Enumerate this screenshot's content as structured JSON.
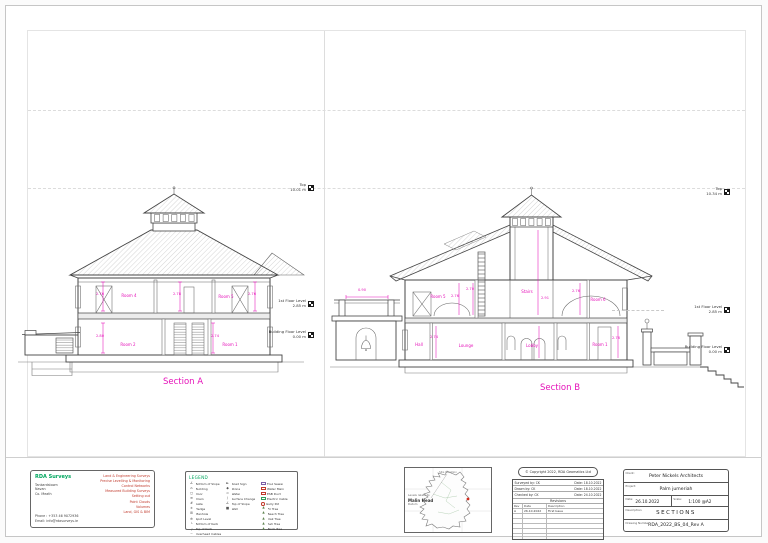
{
  "sectionA": {
    "title": "Section A",
    "levels": [
      {
        "label": "Top",
        "value": "10.01 m"
      },
      {
        "label": "1st Floor Level",
        "value": "2.85 m"
      },
      {
        "label": "Building Floor Level",
        "value": "0.00 m"
      }
    ],
    "labels": [
      {
        "text": "2.76"
      },
      {
        "text": "2.78"
      },
      {
        "text": "2.76"
      },
      {
        "text": "Room 4"
      },
      {
        "text": "Room 5"
      },
      {
        "text": "2.80"
      },
      {
        "text": "2.74"
      },
      {
        "text": "Room 2"
      },
      {
        "text": "Room 1"
      }
    ]
  },
  "sectionB": {
    "title": "Section B",
    "levels": [
      {
        "label": "Top",
        "value": "10.34 m"
      },
      {
        "label": "1st Floor Level",
        "value": "2.85 m"
      },
      {
        "label": "Building Floor Level",
        "value": "0.00 m"
      }
    ],
    "labels": [
      {
        "text": "Room 5"
      },
      {
        "text": "2.76"
      },
      {
        "text": "2.70"
      },
      {
        "text": "Stairs"
      },
      {
        "text": "2.91"
      },
      {
        "text": "2.76"
      },
      {
        "text": "Room 6"
      },
      {
        "text": "0.90"
      },
      {
        "text": "Hall"
      },
      {
        "text": "2.74"
      },
      {
        "text": "Lounge"
      },
      {
        "text": "Lobby"
      },
      {
        "text": "Room 1"
      },
      {
        "text": "2.76"
      }
    ]
  },
  "surveyor": {
    "name": "RDA Surveys",
    "address": [
      "Tankardstown",
      "Navan",
      "Co. Meath"
    ],
    "phone": "Phone : +353 46 9072936",
    "email": "Email: info@rdasurveys.ie",
    "services": [
      "Land & Engineering Surveys",
      "Precise Levelling & Monitoring",
      "Control Networks",
      "Measured Building Surveys",
      "Setting out",
      "Point Clouds",
      "Volumes",
      "Land, GIS & BIM"
    ]
  },
  "legend": {
    "title": "LEGEND",
    "col1": [
      {
        "icon": "slope",
        "label": "Bottom of Slope"
      },
      {
        "icon": "building",
        "label": "Building"
      },
      {
        "icon": "door",
        "label": "Door"
      },
      {
        "icon": "drain",
        "label": "Drain"
      },
      {
        "icon": "gate",
        "label": "Gate"
      },
      {
        "icon": "hedge",
        "label": "Hedge"
      },
      {
        "icon": "manhole",
        "label": "Manhole"
      },
      {
        "icon": "spot-level",
        "label": "Spot Level"
      },
      {
        "icon": "kerb-bottom",
        "label": "Bottom of Kerb"
      },
      {
        "icon": "kerb-top",
        "label": "Top of Kerb"
      },
      {
        "icon": "cables",
        "label": "Overhead Cables"
      }
    ],
    "col2": [
      {
        "icon": "sign",
        "label": "Road Sign"
      },
      {
        "icon": "stone",
        "label": "Stone"
      },
      {
        "icon": "water",
        "label": "Water"
      },
      {
        "icon": "surface",
        "label": "Surface Change"
      },
      {
        "icon": "slope",
        "label": "Top of Slope"
      },
      {
        "icon": "wall",
        "label": "Wall"
      }
    ],
    "col3": [
      {
        "icon": "box-purple",
        "label": "Foul Sewer"
      },
      {
        "icon": "box-red",
        "label": "Water Main"
      },
      {
        "icon": "box-red",
        "label": "ESB Duct"
      },
      {
        "icon": "box-green",
        "label": "Electric Cable"
      },
      {
        "icon": "circle-red",
        "label": "Gully Pot"
      },
      {
        "icon": "tree",
        "label": "Fir Tree"
      },
      {
        "icon": "tree",
        "label": "Beech Tree"
      },
      {
        "icon": "tree",
        "label": "Oak Tree"
      },
      {
        "icon": "tree",
        "label": "Ash Tree"
      },
      {
        "icon": "tree",
        "label": "Birch Tree"
      }
    ]
  },
  "map": {
    "title": "Site Location",
    "datum_intro": "Levels relate to",
    "datum_name": "Malin Head",
    "datum_word": "Datum"
  },
  "copyright": {
    "notice": "© Copyright 2022, RDA Geomatics Ltd",
    "credits": [
      {
        "left": "Surveyed by:  CK",
        "right": "Date: 18.10.2022"
      },
      {
        "left": "Drawn by:  CK",
        "right": "Date: 18.10.2022"
      },
      {
        "left": "Checked by:  CK",
        "right": "Date: 24.10.2022"
      }
    ],
    "revisions_title": "Revisions",
    "rev_headers": [
      "Rev",
      "Date",
      "Description"
    ],
    "rev_rows": [
      [
        "A",
        "26.10.2022",
        "First Issue"
      ]
    ]
  },
  "titleblock": {
    "client_label": "Client:",
    "client": "Peter Nickels Architects",
    "project_label": "Project:",
    "project": "Palm jumeriah",
    "date_label": "Date:",
    "date": "26.10.2022",
    "scale_label": "Scale:",
    "scale": "1:100 @A2",
    "description_label": "Description:",
    "description": "SECTIONS",
    "number_label": "Drawing Number:",
    "number": "RDA_2022_BS_04_Rev A"
  },
  "colors": {
    "magenta": "#e512b9",
    "green": "#00a65e",
    "red": "#c0392b"
  }
}
